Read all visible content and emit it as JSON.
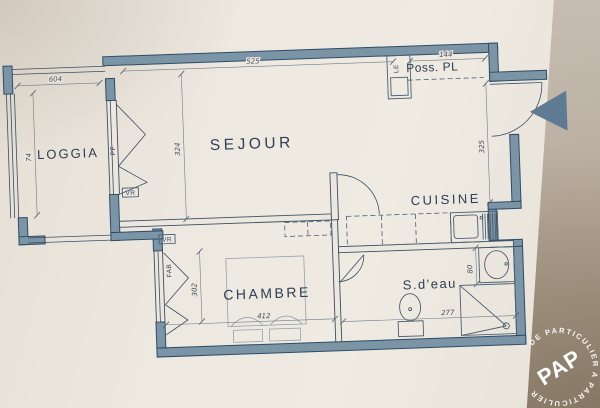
{
  "plan": {
    "rooms": {
      "loggia": "LOGGIA",
      "sejour": "SEJOUR",
      "cuisine": "CUISINE",
      "chambre": "CHAMBRE",
      "sdeau": "S.d'eau",
      "poss_pl": "Poss. PL"
    },
    "openings": {
      "pf": "PF",
      "vr": "VR",
      "fab": "FAB",
      "le": "LE"
    },
    "dimensions": {
      "loggia_width": "604",
      "loggia_depth": "74",
      "sejour_width": "525",
      "sejour_depth": "324",
      "entry_pl_width": "144",
      "cuisine_depth": "325",
      "chambre_window": "302",
      "chambre_width": "412",
      "sdeau_width": "277",
      "basin": "80"
    }
  },
  "watermark": {
    "ring_text": "DE PARTICULIER A PARTICULIER",
    "brand": "PAP"
  },
  "colors": {
    "wall": "#7b94a6",
    "wall_edge": "#2f4c66",
    "ink": "#3c4f63",
    "label": "#2e3e54",
    "paper": "#ece7df",
    "backdrop": "#b3a695",
    "arrow": "#5f7a93"
  }
}
